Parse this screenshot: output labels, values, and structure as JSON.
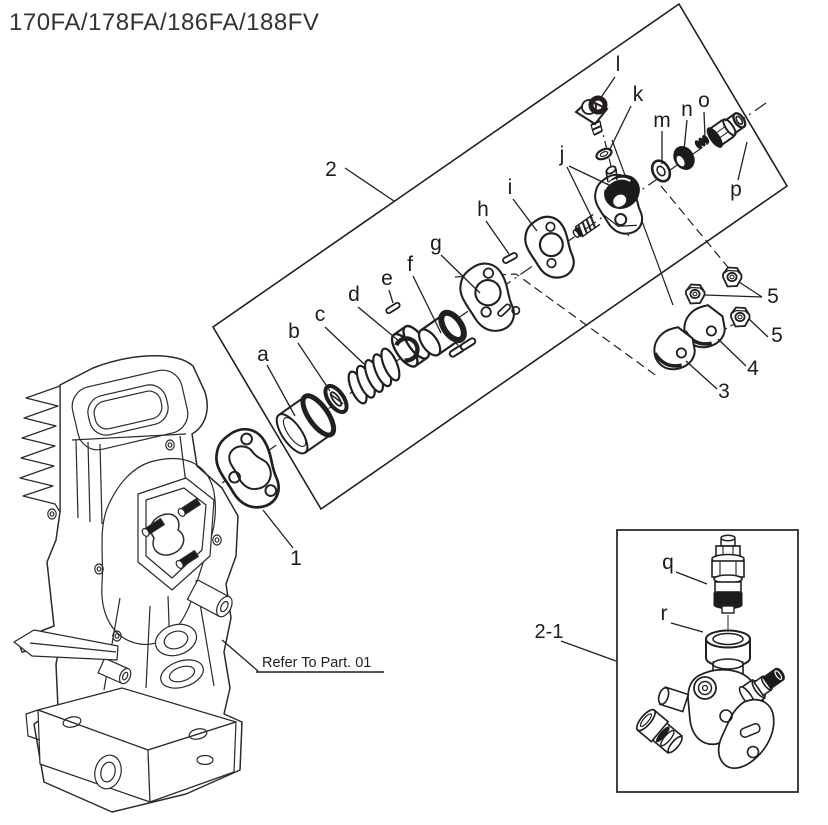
{
  "title": "170FA/178FA/186FA/188FV",
  "note": "Refer To Part. 01",
  "colors": {
    "line": "#231f20",
    "background": "#ffffff",
    "dark_fill": "#1b1b1b"
  },
  "callouts": {
    "numbers": {
      "gasket": "1",
      "assembly_box": "2",
      "clamp_plate_small": "3",
      "clamp_plate_large": "4",
      "nuts_pair": "5",
      "nut_single": "5",
      "inset_assembly": "2-1"
    },
    "letters": {
      "a": "a",
      "b": "b",
      "c": "c",
      "d": "d",
      "e": "e",
      "f": "f",
      "g": "g",
      "h": "h",
      "i": "i",
      "j": "j",
      "k": "k",
      "l": "l",
      "m": "m",
      "n": "n",
      "o": "o",
      "p": "p",
      "q": "q",
      "r": "r"
    }
  }
}
